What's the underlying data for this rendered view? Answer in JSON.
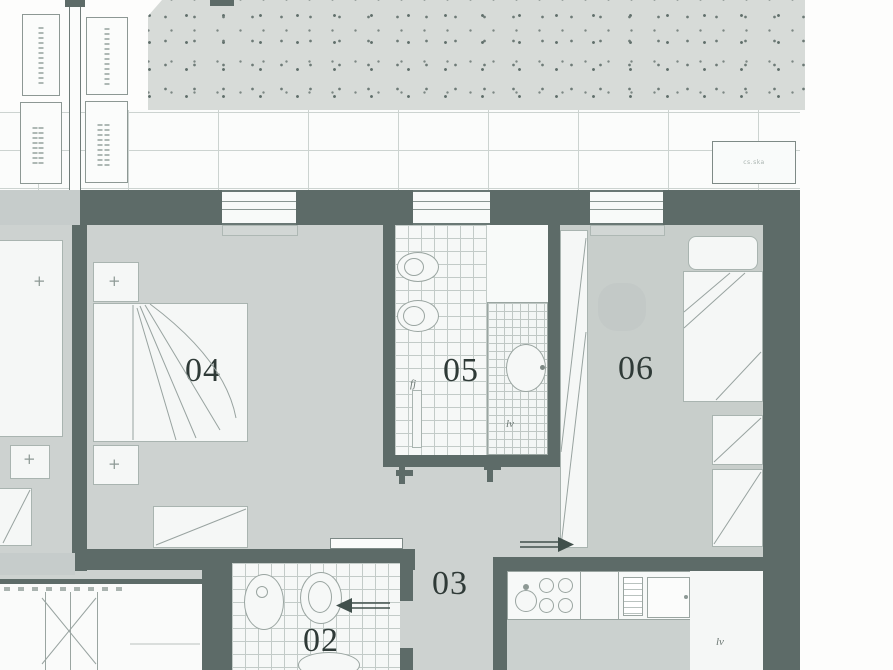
{
  "document": {
    "kind": "scanned apartment floor plan",
    "description": "Upper portion of an apartment floor plan with terrace, two bedrooms, two bathrooms, hallway and kitchen"
  },
  "labels": {
    "r04": "04",
    "r05": "05",
    "r06": "06",
    "r03": "03",
    "r02": "02",
    "lv_bath05": "lv",
    "fj_bath05": "fj",
    "lv_kitchen": "lv",
    "terrace_tag": "cs.ska"
  },
  "annotations": {
    "entry_arrow_bath02_direction": "left",
    "entry_arrow_kitchen_direction": "right"
  },
  "colors": {
    "wall": "#5d6b68",
    "floor": "#cdd2d0",
    "floor_dark": "#c8cecb",
    "stipple_background": "#d7dbd8",
    "stipple_dot": "#6d7a76",
    "tile_line": "#c3cbc8",
    "furniture_line": "#a9b4b0",
    "label_text": "#2f3a37"
  }
}
